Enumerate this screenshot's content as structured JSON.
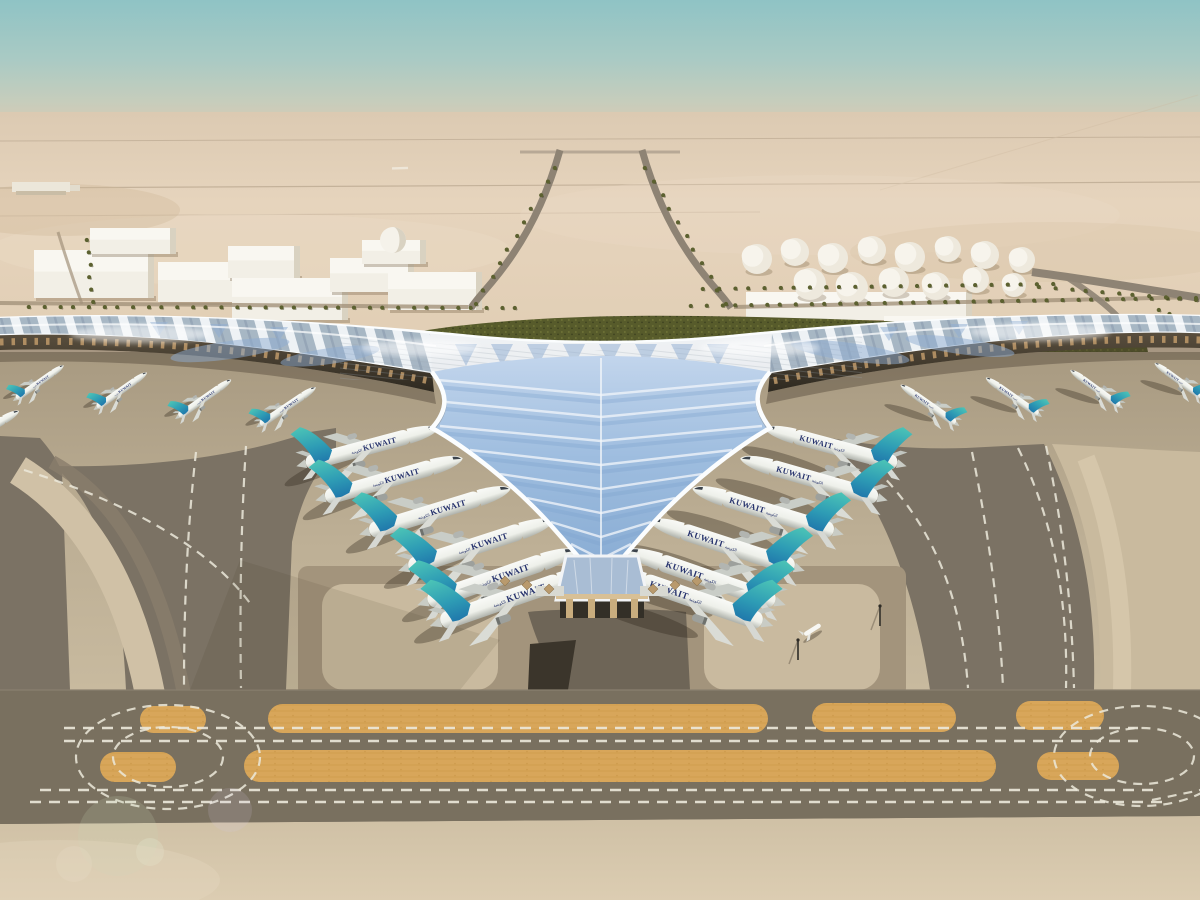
{
  "airline": {
    "name": "KUWAIT",
    "arabic": "الكويتية"
  },
  "palette": {
    "sky_top": "#8fc3c5",
    "sky_mid": "#b7cdc2",
    "horizon": "#dccab2",
    "desert": "#e2cfb6",
    "desert_light": "#ecdcc6",
    "apron_light": "#c9ba9f",
    "apron_mid": "#b3a58b",
    "asphalt": "#7b7264",
    "asphalt_band": "#79705f",
    "orange_strip": "#d8a65a",
    "marking_white": "#ece9db",
    "roof_silver": "#e4e8ec",
    "roof_glass": "#9ebddf",
    "roof_rim": "#fbfdfe",
    "green_band": "#575b2b",
    "recess_dark": "#3e382e",
    "tail_teal_top": "#4cc4b6",
    "tail_blue_base": "#1f76ab",
    "titles_navy": "#27336d",
    "building_white": "#f2efe6",
    "sand_fg": "#d3c4a9"
  },
  "fleet": {
    "total_visible_aircraft": 21,
    "groups": [
      {
        "id": "left-pier-gates",
        "facing": "right",
        "planes": [
          [
            40,
            382,
            -35,
            0.38
          ],
          [
            122,
            390,
            -35,
            0.4
          ],
          [
            205,
            398,
            -35,
            0.42
          ],
          [
            288,
            406,
            -34,
            0.44
          ]
        ]
      },
      {
        "id": "right-pier-gates",
        "facing": "left",
        "planes": [
          [
            928,
            404,
            35,
            0.44
          ],
          [
            1012,
            396,
            35,
            0.42
          ],
          [
            1095,
            388,
            36,
            0.4
          ],
          [
            1178,
            380,
            36,
            0.38
          ]
        ]
      },
      {
        "id": "left-v-gates",
        "facing": "right",
        "planes": [
          [
            372,
            446,
            -15,
            0.9
          ],
          [
            394,
            478,
            -16,
            0.94
          ],
          [
            440,
            510,
            -17,
            0.97
          ],
          [
            481,
            544,
            -18,
            1.0
          ],
          [
            502,
            576,
            -19,
            1.03
          ],
          [
            517,
            596,
            -19,
            1.06
          ]
        ]
      },
      {
        "id": "right-v-gates",
        "facing": "left",
        "planes": [
          [
            831,
            446,
            15,
            0.9
          ],
          [
            809,
            478,
            16,
            0.94
          ],
          [
            763,
            510,
            17,
            0.97
          ],
          [
            722,
            544,
            18,
            1.0
          ],
          [
            701,
            576,
            19,
            1.03
          ],
          [
            686,
            596,
            19,
            1.06
          ]
        ]
      },
      {
        "id": "remote-stand",
        "facing": "right",
        "planes": [
          [
            -14,
            430,
            -30,
            0.5
          ]
        ]
      }
    ]
  },
  "terminal": {
    "valley_chevron_rows": [
      [
        380,
        438
      ],
      [
        402,
        446
      ],
      [
        426,
        440
      ],
      [
        450,
        470
      ],
      [
        474,
        500
      ],
      [
        498,
        527
      ],
      [
        522,
        551
      ],
      [
        544,
        571
      ],
      [
        562,
        587
      ]
    ],
    "column_diamonds": [
      [
        505,
        581
      ],
      [
        527,
        585
      ],
      [
        549,
        589
      ],
      [
        653,
        589
      ],
      [
        675,
        585
      ],
      [
        697,
        581
      ]
    ]
  },
  "ground": {
    "orange_strips_upper": [
      [
        140,
        706,
        66,
        27
      ],
      [
        268,
        704,
        500,
        29
      ],
      [
        812,
        703,
        144,
        29
      ],
      [
        1016,
        701,
        88,
        29
      ]
    ],
    "orange_strips_lower": [
      [
        100,
        752,
        76,
        30
      ],
      [
        244,
        750,
        752,
        32
      ],
      [
        1037,
        752,
        82,
        28
      ]
    ],
    "dash_rows": [
      [
        64,
        728,
        1138
      ],
      [
        64,
        741,
        1138
      ],
      [
        40,
        790,
        1160
      ],
      [
        30,
        802,
        1168
      ]
    ],
    "loops": [
      [
        168,
        757,
        92,
        52
      ],
      [
        168,
        757,
        55,
        30
      ],
      [
        1142,
        756,
        88,
        50
      ],
      [
        1142,
        756,
        52,
        28
      ]
    ],
    "masts": [
      [
        880,
        606
      ],
      [
        798,
        640
      ]
    ],
    "bizjet": {
      "x": 812,
      "y": 630
    }
  },
  "midground": {
    "buildings": [
      [
        34,
        250,
        120,
        48
      ],
      [
        90,
        228,
        86,
        26
      ],
      [
        158,
        262,
        92,
        40
      ],
      [
        228,
        246,
        72,
        32
      ],
      [
        232,
        278,
        116,
        42
      ],
      [
        330,
        258,
        84,
        34
      ],
      [
        362,
        240,
        64,
        24
      ],
      [
        388,
        272,
        94,
        38
      ],
      [
        746,
        292,
        226,
        28
      ],
      [
        884,
        316,
        118,
        22
      ]
    ],
    "dome": {
      "cx": 393,
      "cy": 240,
      "r": 13
    },
    "tanks": [
      [
        757,
        259,
        15
      ],
      [
        795,
        252,
        14
      ],
      [
        833,
        258,
        15
      ],
      [
        872,
        250,
        14
      ],
      [
        910,
        257,
        15
      ],
      [
        948,
        249,
        13
      ],
      [
        985,
        255,
        14
      ],
      [
        1022,
        260,
        13
      ],
      [
        810,
        284,
        16
      ],
      [
        852,
        288,
        16
      ],
      [
        894,
        282,
        15
      ],
      [
        936,
        286,
        14
      ],
      [
        976,
        280,
        13
      ],
      [
        1014,
        285,
        12
      ]
    ],
    "palm_rows": [
      [
        30,
        307,
        516,
        308,
        34
      ],
      [
        692,
        306,
        1196,
        298,
        35
      ],
      [
        704,
        289,
        1052,
        284,
        24
      ],
      [
        556,
        168,
        476,
        304,
        11
      ],
      [
        646,
        168,
        726,
        304,
        11
      ],
      [
        88,
        240,
        92,
        302,
        6
      ],
      [
        1040,
        287,
        1196,
        300,
        11
      ],
      [
        1160,
        310,
        1198,
        326,
        5
      ]
    ]
  }
}
